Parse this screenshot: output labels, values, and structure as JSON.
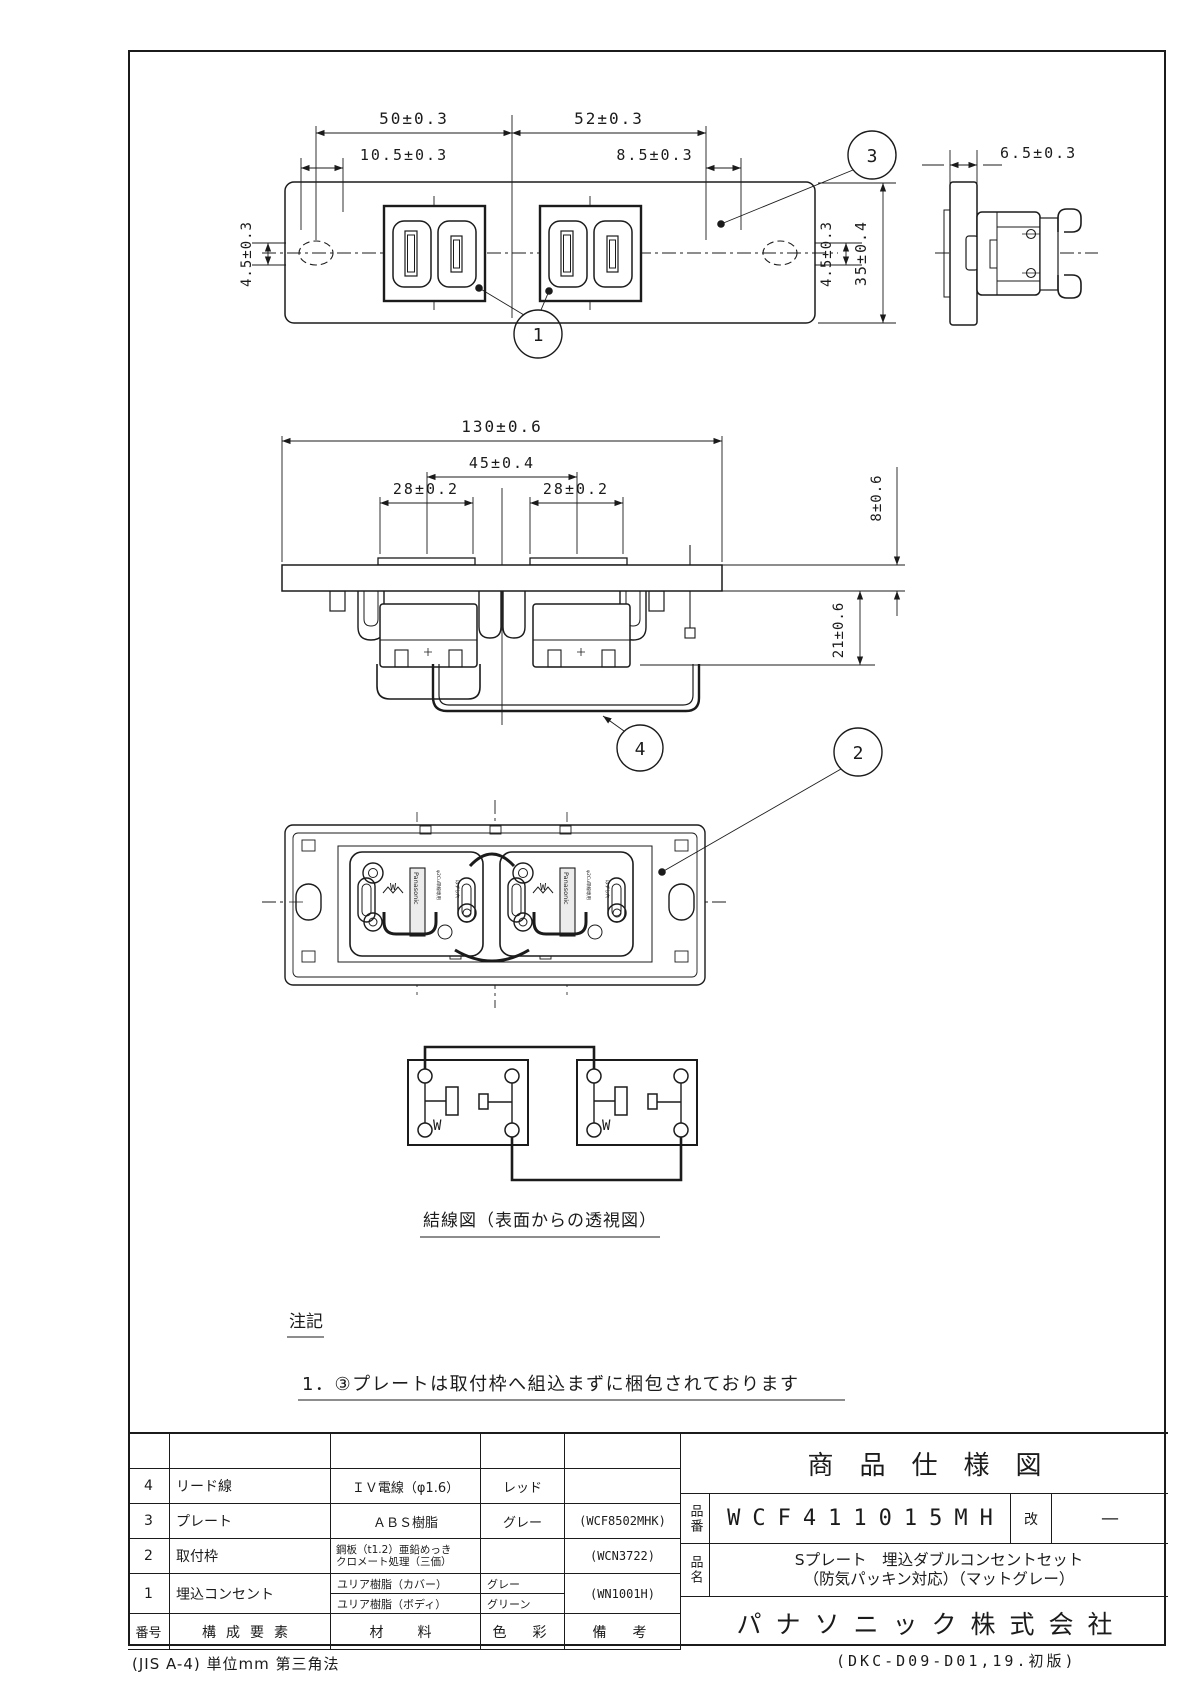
{
  "views": {
    "top_view": {
      "dims": {
        "d50": "50±0.3",
        "d52": "52±0.3",
        "d10_5": "10.5±0.3",
        "d8_5": "8.5±0.3",
        "d4_5_left": "4.5±0.3",
        "d4_5_right": "4.5±0.3",
        "d35": "35±0.4"
      }
    },
    "side_view": {
      "dims": {
        "d6_5": "6.5±0.3"
      }
    },
    "front_view": {
      "dims": {
        "d130": "130±0.6",
        "d45": "45±0.4",
        "d28_left": "28±0.2",
        "d28_right": "28±0.2",
        "d8": "8±0.6",
        "d21": "21±0.6"
      }
    },
    "back_view": {
      "brand": "Panasonic",
      "micro_text_1": "φ2Cu単線専用",
      "micro_text_2": "はずし穴",
      "w_mark": "W"
    },
    "wiring": {
      "w_label": "W",
      "caption": "結線図（表面からの透視図）"
    }
  },
  "callouts": {
    "c1": "1",
    "c2": "2",
    "c3": "3",
    "c4": "4"
  },
  "notes": {
    "heading": "注記",
    "items": [
      "1．③プレートは取付枠へ組込まずに梱包されております"
    ]
  },
  "bom": {
    "headers": {
      "no": "番号",
      "component": "構成要素",
      "material": "材　料",
      "color": "色　彩",
      "remarks": "備　考"
    },
    "rows": [
      {
        "no": "4",
        "component": "リード線",
        "material": "ＩＶ電線（φ1.6）",
        "color": "レッド",
        "remarks": ""
      },
      {
        "no": "3",
        "component": "プレート",
        "material": "ＡＢＳ樹脂",
        "color": "グレー",
        "remarks": "(WCF8502MHK)"
      },
      {
        "no": "2",
        "component": "取付枠",
        "material_line1": "鋼板（t1.2）亜鉛めっき",
        "material_line2": "クロメート処理（三価）",
        "color": "",
        "remarks": "(WCN3722)"
      },
      {
        "no": "1",
        "component": "埋込コンセント",
        "material_line1": "ユリア樹脂（カバー）",
        "material_line2": "ユリア樹脂（ボディ）",
        "color_line1": "グレー",
        "color_line2": "グリーン",
        "remarks": "(WN1001H)"
      }
    ]
  },
  "title_block": {
    "sheet_title": "商品仕様図",
    "part_no_label": "品番",
    "part_no": "WCF411015MH",
    "rev_label": "改",
    "rev_value": "—",
    "product_name_label": "品名",
    "product_name_line1": "Sプレート　埋込ダブルコンセントセット",
    "product_name_line2": "（防気パッキン対応）（マットグレー）",
    "company": "パナソニック株式会社"
  },
  "footer": {
    "left": "(JIS A-4)    単位mm    第三角法",
    "right": "(DKC-D09-D01,19.初版)"
  }
}
